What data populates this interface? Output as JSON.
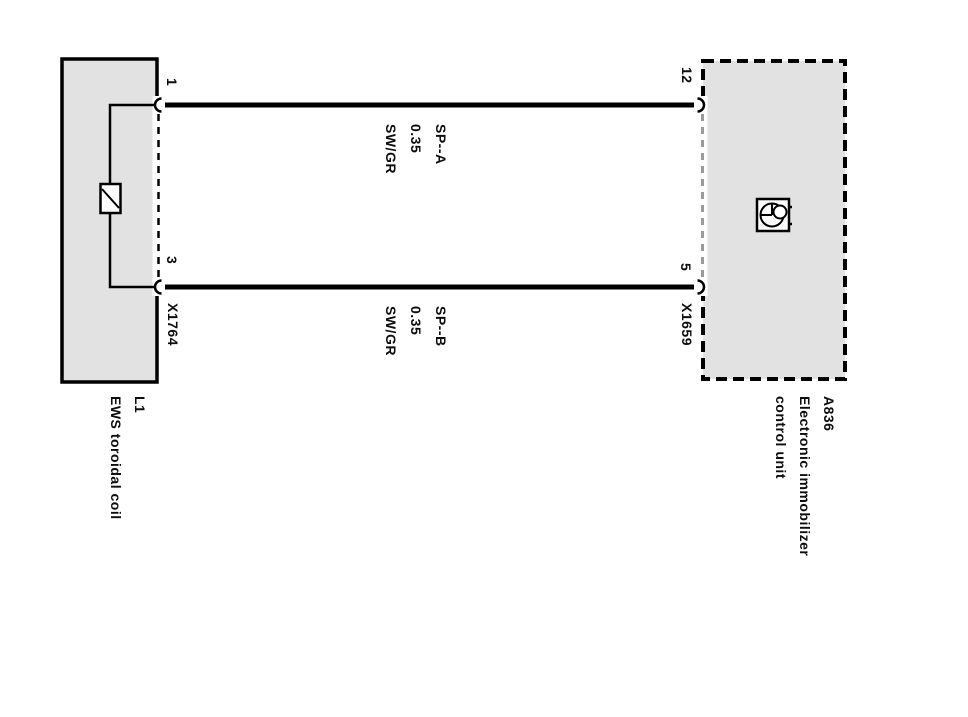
{
  "colors": {
    "background": "#ffffff",
    "box_fill": "#e2e2e2",
    "line": "#000000",
    "connector_dash": "#9a9a9a"
  },
  "left_component": {
    "designator": "L1",
    "name": "EWS toroidal coil",
    "connector": "X1764",
    "pin_top": "1",
    "pin_bottom": "3"
  },
  "right_component": {
    "designator": "A836",
    "name_line_1": "Electronic immobilizer",
    "name_line_2": "control unit",
    "connector": "X1659",
    "pin_top": "12",
    "pin_bottom": "5"
  },
  "wire_top": {
    "circuit": "SP--A",
    "cross_section": "0.35",
    "color_code": "SW/GR"
  },
  "wire_bottom": {
    "circuit": "SP--B",
    "cross_section": "0.35",
    "color_code": "SW/GR"
  }
}
